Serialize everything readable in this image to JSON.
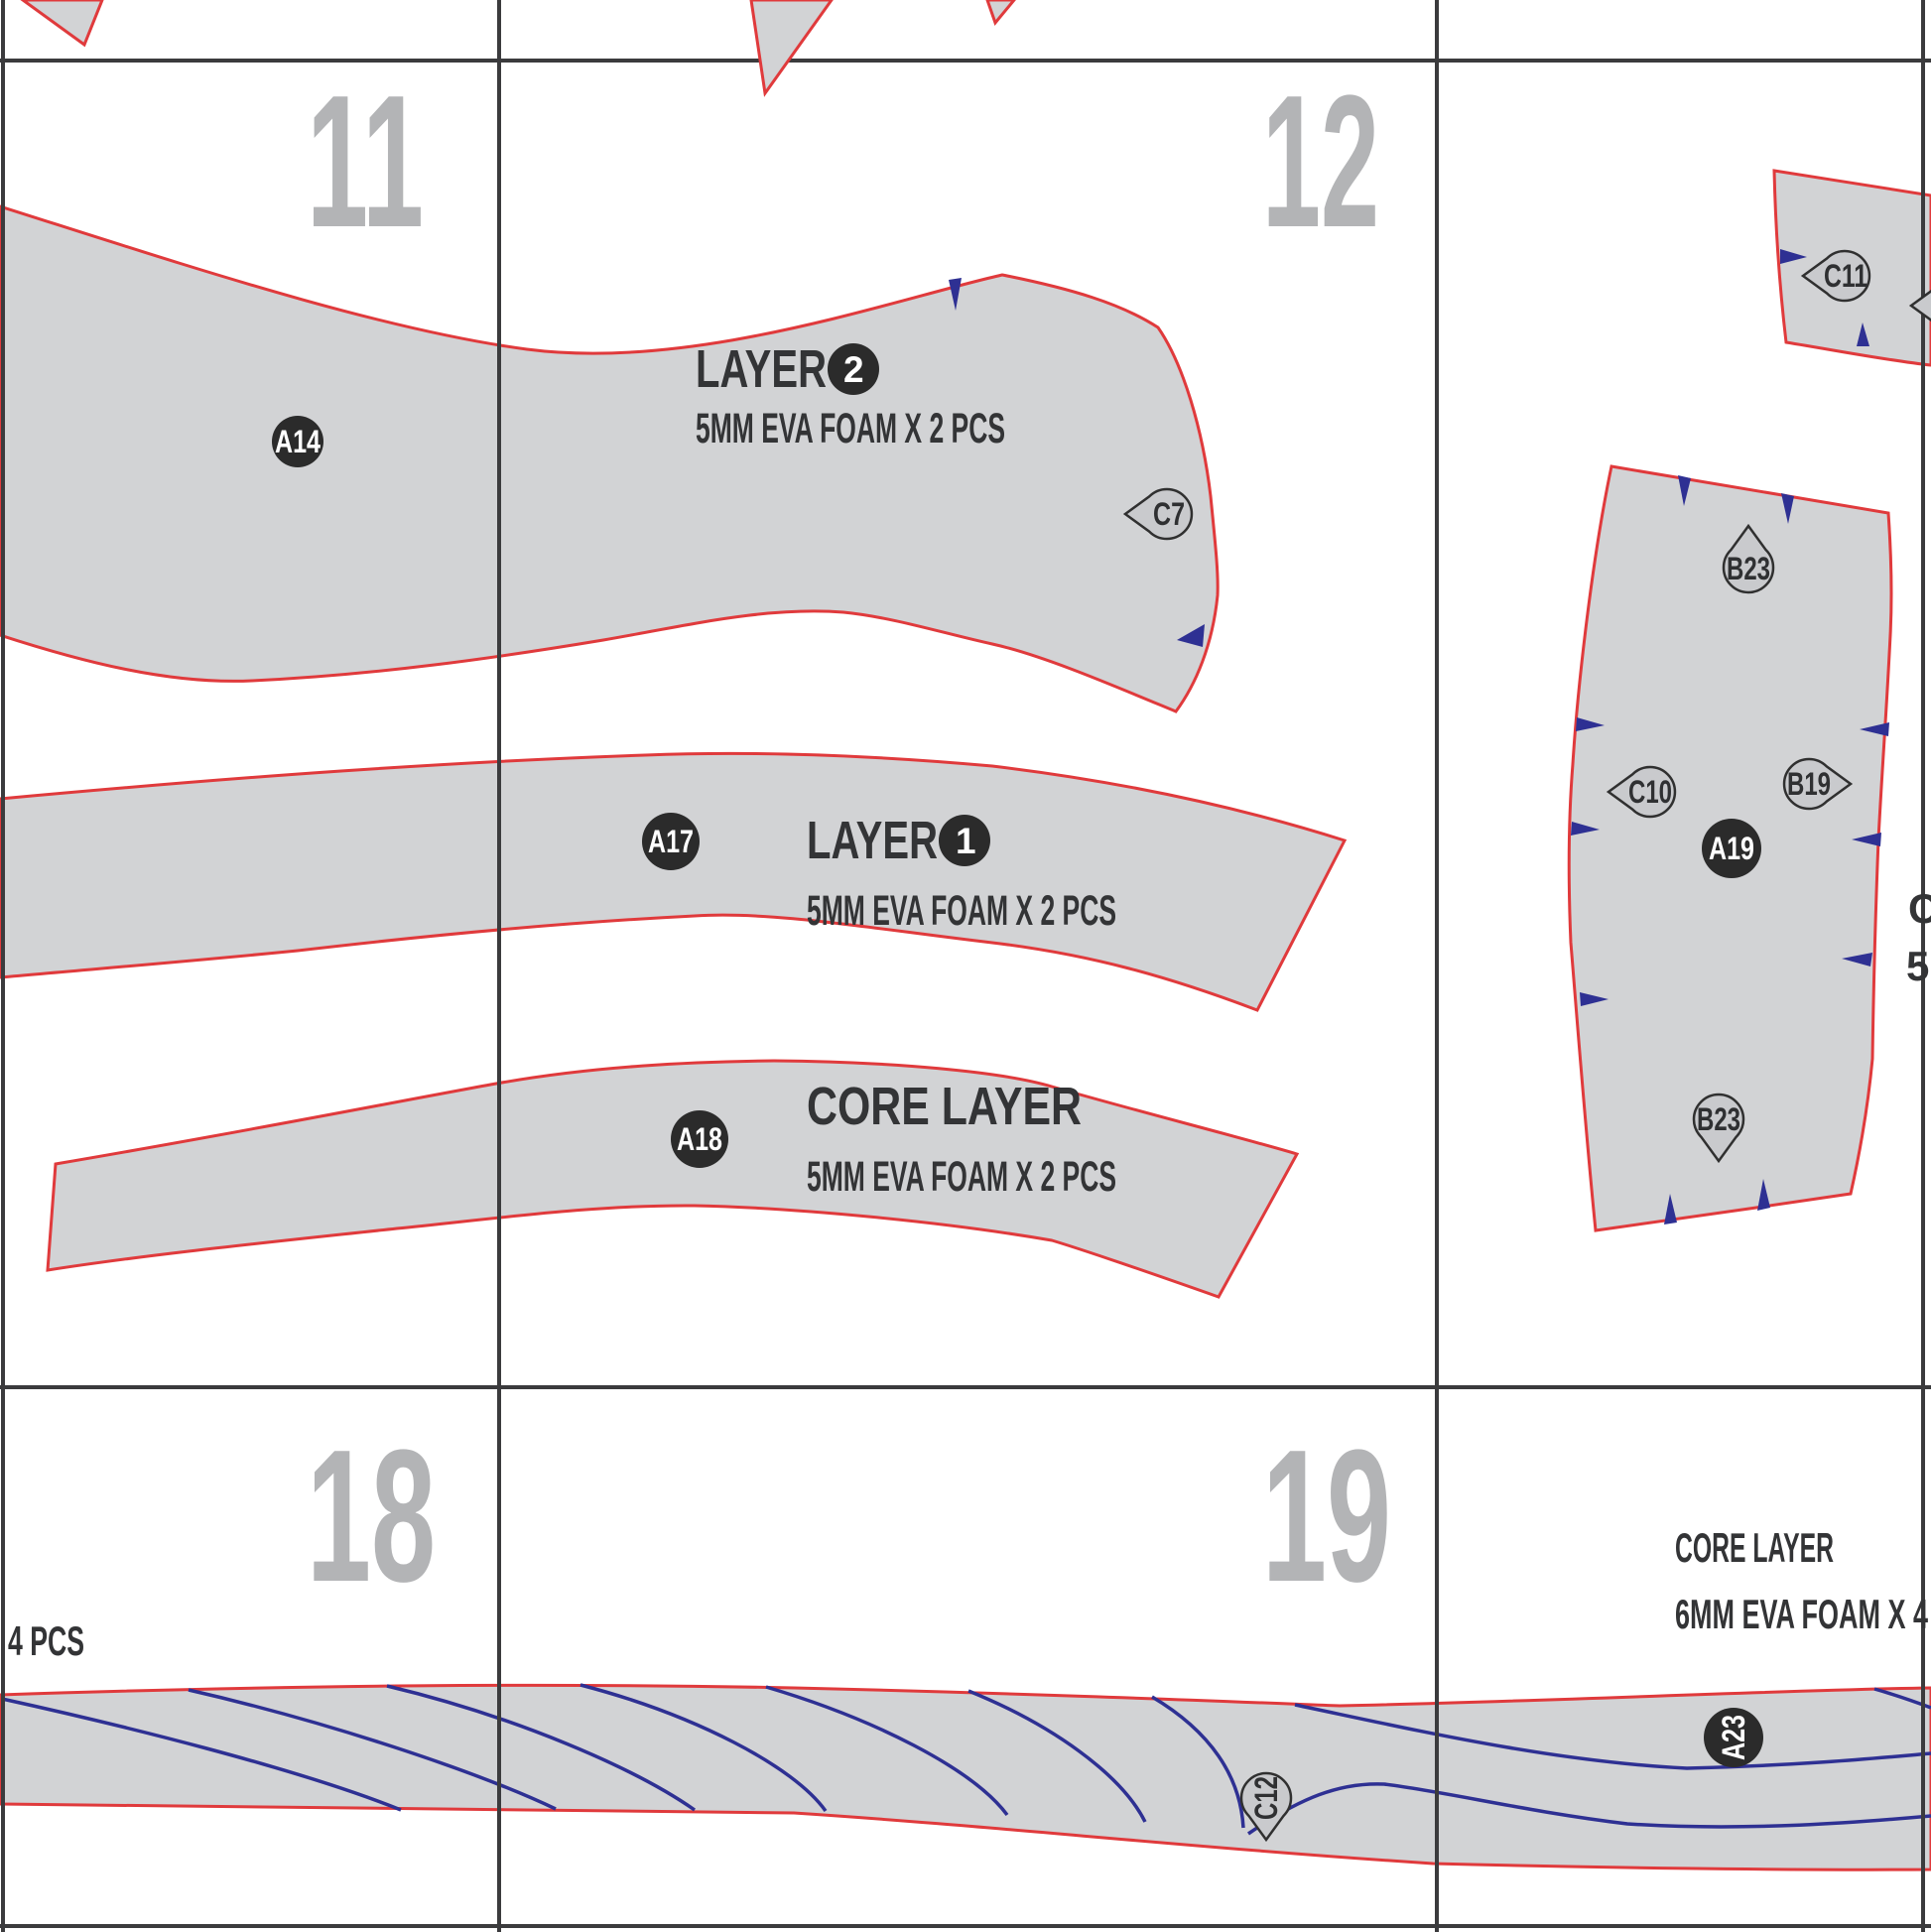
{
  "document": {
    "type": "foam armor pattern sheet",
    "page_numbers": {
      "p11": "11",
      "p12": "12",
      "p18": "18",
      "p19": "19"
    }
  },
  "labels": {
    "layer2_title": "LAYER",
    "layer2_num": "2",
    "layer2_spec": "5MM EVA FOAM X 2 PCS",
    "layer1_title": "LAYER",
    "layer1_num": "1",
    "layer1_spec": "5MM EVA FOAM X 2 PCS",
    "core_title": "CORE LAYER",
    "core_spec": "5MM EVA FOAM X 2 PCS",
    "right_core_title": "CORE LAYER",
    "right_core_spec": "6MM EVA FOAM X 4",
    "left_edge_partial": "4 PCS",
    "right_edge_partial_line1": "C",
    "right_edge_partial_line2": "5M"
  },
  "badges": {
    "a14": "A14",
    "a17": "A17",
    "a18": "A18",
    "a19": "A19",
    "a23": "A23"
  },
  "markers": {
    "c7": "C7",
    "c11": "C11",
    "b23_top": "B23",
    "c10": "C10",
    "b19": "B19",
    "b23_bottom": "B23",
    "c12": "C12"
  },
  "colors": {
    "piece_fill": "#d2d3d5",
    "piece_outline": "#e03a3c",
    "notch_blue": "#2e3093",
    "badge_bg": "#2b2b2b",
    "badge_text": "#ffffff",
    "marker_fill": "#c9cacd",
    "marker_outline": "#303030",
    "grid_line": "#3b3b3d",
    "page_number_gray": "#b3b4b6",
    "label_text": "#333436"
  }
}
